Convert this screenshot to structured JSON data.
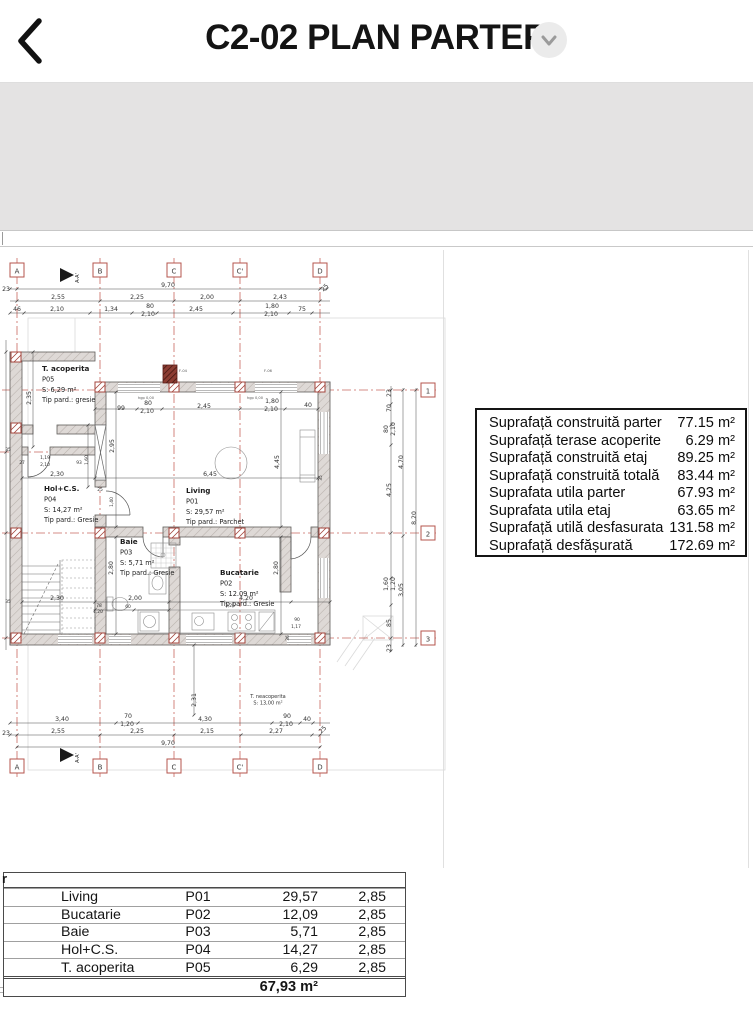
{
  "header": {
    "title": "C2-02 PLAN PARTER"
  },
  "plan": {
    "grid_letters": [
      "A",
      "B",
      "C",
      "C'",
      "D"
    ],
    "grid_numbers": [
      "1",
      "2",
      "3"
    ],
    "section_label": "A-A'",
    "dims_top": [
      "23",
      "9,70",
      "25",
      "2,55",
      "2,25",
      "2,00",
      "2,43",
      "46",
      "2,10",
      "1,34",
      "80",
      "2,10",
      "2,45",
      "1,80",
      "2,10",
      "75"
    ],
    "dims_bottom": [
      "3,40",
      "70",
      "1,20",
      "4,30",
      "90",
      "2,10",
      "40",
      "2,31",
      "23",
      "2,55",
      "2,25",
      "2,15",
      "2,27",
      "25",
      "9,70"
    ],
    "dims_right": [
      "23",
      "70",
      "80",
      "2,10",
      "4,25",
      "1,60",
      "1,20",
      "85",
      "23",
      "4,70",
      "3,05",
      "8,20"
    ],
    "dims_inner": [
      "99",
      "80",
      "2,10",
      "2,45",
      "1,80",
      "2,10",
      "40",
      "hgp 0,00",
      "hgp 0,00",
      "2,95",
      "6,45",
      "2,30",
      "27",
      "1,19",
      "2,10",
      "93",
      "1,60",
      "2,35",
      "1,40",
      "2,30",
      "2,00",
      "4,20",
      "78",
      "1,20",
      "60",
      "2,80",
      "2,80",
      "3,26",
      "4,45",
      "35",
      "35",
      "25",
      "35",
      "90",
      "1,17",
      "36",
      "F-04",
      "F-06"
    ],
    "rooms": {
      "t_acoperita": {
        "name": "T. acoperita",
        "code": "P05",
        "area": "S: 6,29 m²",
        "floor": "Tip pard.:  gresie"
      },
      "hol": {
        "name": "Hol+C.S.",
        "code": "P04",
        "area": "S: 14,27 m²",
        "floor": "Tip pard.: Gresie"
      },
      "living": {
        "name": "Living",
        "code": "P01",
        "area": "S: 29,57 m²",
        "floor": "Tip pard.: Parchet"
      },
      "baie": {
        "name": "Baie",
        "code": "P03",
        "area": "S: 5,71 m²",
        "floor": "Tip pard.: Gresie"
      },
      "bucatarie": {
        "name": "Bucatarie",
        "code": "P02",
        "area": "S: 12.09 m²",
        "floor": "Tip pard.: Gresie"
      },
      "t_neacoperita": {
        "name": "T. neacoperita",
        "area": "S: 13,00 m²"
      }
    }
  },
  "area_table": {
    "rows": [
      {
        "label": "Suprafață construită parter",
        "value": "77.15 m²"
      },
      {
        "label": "Suprafață terase acoperite",
        "value": "6.29 m²"
      },
      {
        "label": "Suprafață construită etaj",
        "value": "89.25 m²"
      },
      {
        "label": "Suprafață construită totală",
        "value": "83.44 m²"
      },
      {
        "label": "Suprafata utila parter",
        "value": "67.93 m²"
      },
      {
        "label": "Suprafata utila etaj",
        "value": "63.65 m²"
      },
      {
        "label": "Suprafață  utilă desfasurata",
        "value": "131.58 m²"
      },
      {
        "label": "Suprafață desfășurată",
        "value": "172.69 m²"
      }
    ]
  },
  "room_table": {
    "header_fragment": "r",
    "rows": [
      {
        "name": "Living",
        "code": "P01",
        "area": "29,57",
        "height": "2,85"
      },
      {
        "name": "Bucatarie",
        "code": "P02",
        "area": "12,09",
        "height": "2,85"
      },
      {
        "name": "Baie",
        "code": "P03",
        "area": "5,71",
        "height": "2,85"
      },
      {
        "name": "Hol+C.S.",
        "code": "P04",
        "area": "14,27",
        "height": "2,85"
      },
      {
        "name": "T. acoperita",
        "code": "P05",
        "area": "6,29",
        "height": "2,85"
      }
    ],
    "total": "67,93 m²"
  },
  "watermark": "STORIA"
}
